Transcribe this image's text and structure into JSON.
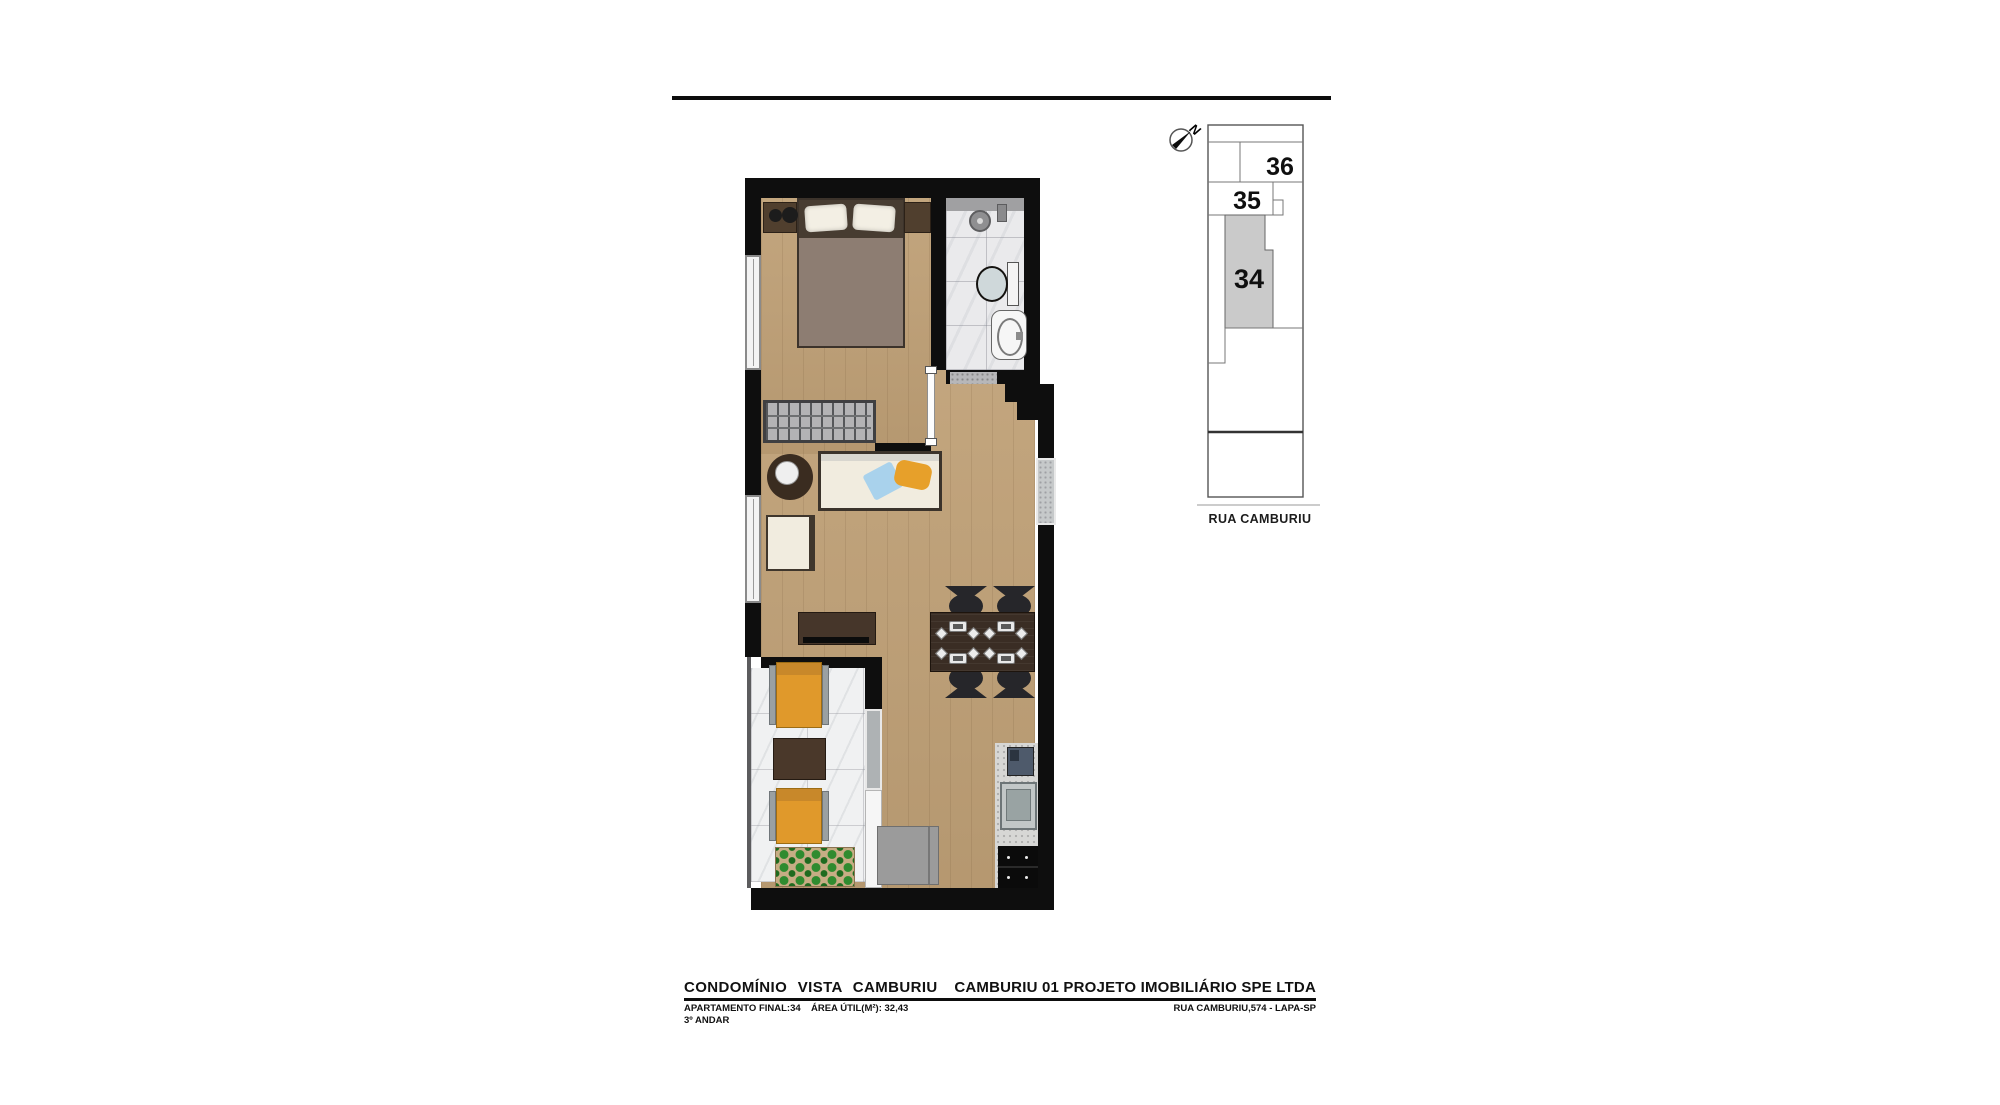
{
  "palette": {
    "wall": "#0e0e0e",
    "wood": "#bfa076",
    "tile": "#eaeaec",
    "marble": "#f0f1f2",
    "cream": "#f1ecdf",
    "counter": "#d7d7d5",
    "accent_orange": "#e0992b",
    "pillow_blue": "#a9d2ec",
    "pillow_orange": "#e7a02a",
    "unit_highlight": "#cacaca",
    "outline": "#6b6b6b"
  },
  "key_plan": {
    "north_label": "N",
    "street_label": "RUA CAMBURIU",
    "units": [
      {
        "id": "36"
      },
      {
        "id": "35"
      },
      {
        "id": "34",
        "highlighted": true
      }
    ]
  },
  "footer": {
    "left_title": "CONDOMÍNIO VISTA CAMBURIU",
    "right_title": "CAMBURIU 01 PROJETO IMOBILIÁRIO SPE LTDA",
    "apartment": "APARTAMENTO FINAL:34",
    "floor": "3º ANDAR",
    "area": "ÁREA ÚTIL(M²): 32,43",
    "address": "RUA CAMBURIU,574 - LAPA-SP"
  }
}
